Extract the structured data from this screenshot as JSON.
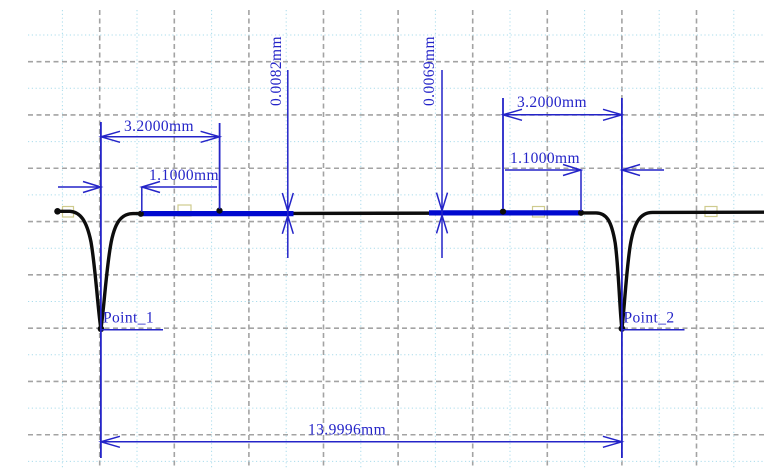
{
  "chart_data": {
    "type": "line",
    "title": "",
    "x_unit": "mm",
    "y_unit": "mm",
    "profile_shape": "flat horizontal surface trace with two narrow V-shaped grooves (pits) at Point_1 and Point_2, highlighted reference segments drawn in blue on the flat surface between the grooves",
    "points": [
      {
        "label": "Point_1"
      },
      {
        "label": "Point_2"
      }
    ],
    "measurements": [
      {
        "label": "3.2000mm",
        "value": 3.2,
        "unit": "mm",
        "orientation": "horizontal",
        "side": "left",
        "from": "Point_1 groove",
        "to": "end of left reference span"
      },
      {
        "label": "1.1000mm",
        "value": 1.1,
        "unit": "mm",
        "orientation": "horizontal",
        "side": "left",
        "from": "Point_1 groove",
        "to": "start of left blue reference segment"
      },
      {
        "label": "0.0082mm",
        "value": 0.0082,
        "unit": "mm",
        "orientation": "vertical",
        "side": "left",
        "from": "left reference segment",
        "to": "surface"
      },
      {
        "label": "0.0069mm",
        "value": 0.0069,
        "unit": "mm",
        "orientation": "vertical",
        "side": "right",
        "from": "right reference segment",
        "to": "surface"
      },
      {
        "label": "3.2000mm",
        "value": 3.2,
        "unit": "mm",
        "orientation": "horizontal",
        "side": "right",
        "from": "start of right reference span",
        "to": "Point_2 groove"
      },
      {
        "label": "1.1000mm",
        "value": 1.1,
        "unit": "mm",
        "orientation": "horizontal",
        "side": "right",
        "from": "end of right blue reference segment",
        "to": "Point_2 groove"
      },
      {
        "label": "13.9996mm",
        "value": 13.9996,
        "unit": "mm",
        "orientation": "horizontal",
        "side": "bottom",
        "from": "Point_1",
        "to": "Point_2"
      }
    ],
    "grid": {
      "vertical": {
        "start": 62.4,
        "step": 37.3,
        "count": 19,
        "y1": 10,
        "y2": 469
      },
      "horizontal": {
        "start": 35.0,
        "step": 26.65,
        "count": 17,
        "x1": 28,
        "x2": 764
      },
      "pattern": "alternating minor dotted light-blue and major dashed gray lines",
      "legend": "none"
    }
  },
  "colors": {
    "dimension_blue": "#2424c8",
    "reference_blue": "#0009cf",
    "profile_black": "#0d0d0d",
    "grid_major_gray": "#a3a3a3",
    "grid_minor_blue": "#aadcec",
    "handle_yellow": "#cfcb8e",
    "background": "#ffffff"
  }
}
